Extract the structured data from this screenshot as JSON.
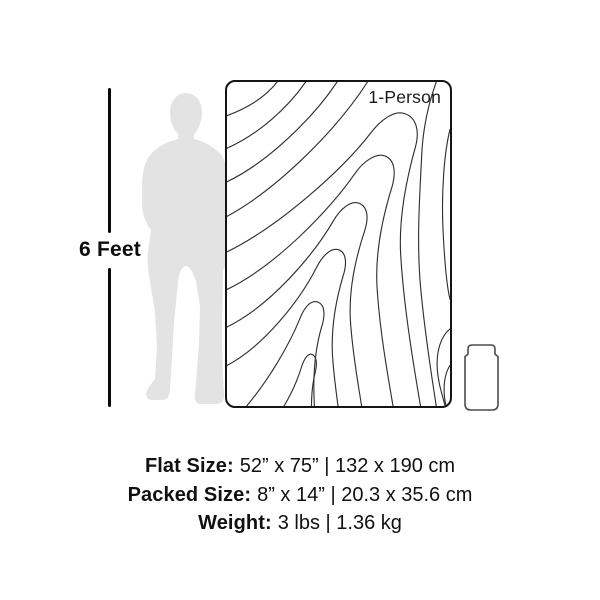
{
  "diagram": {
    "height_label": "6 Feet",
    "product_label": "1-Person"
  },
  "specs": {
    "flat": {
      "label": "Flat Size:",
      "value": "52” x 75” | 132 x 190 cm"
    },
    "packed": {
      "label": "Packed Size:",
      "value": "8” x 14” | 20.3 x 35.6 cm"
    },
    "weight": {
      "label": "Weight:",
      "value": "3 lbs | 1.36 kg"
    }
  },
  "icons": {
    "person": "person-silhouette-icon",
    "packed": "packed-sack-icon"
  },
  "colors": {
    "background": "#ffffff",
    "text": "#111111",
    "silhouette": "#e3e3e3",
    "contour_line": "#2f2f2f",
    "blanket_border": "#141414",
    "packed_stroke": "#4d4d4d",
    "ruler_line": "#0a0a0a"
  }
}
